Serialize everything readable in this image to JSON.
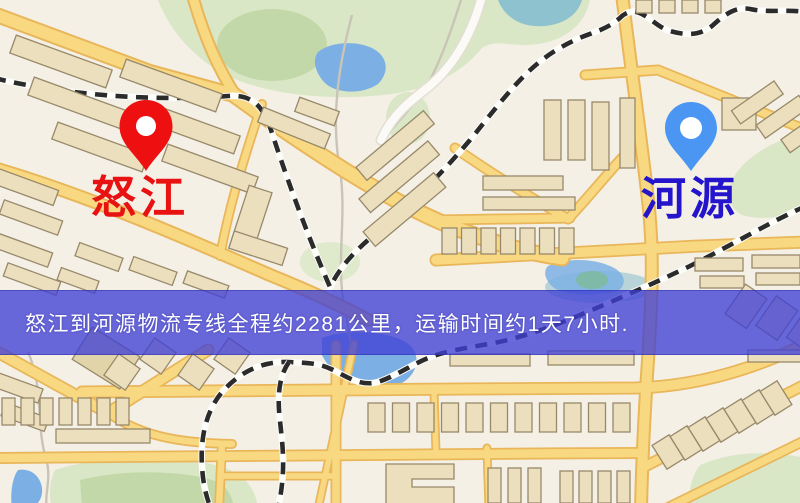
{
  "banner": {
    "text": "怒江到河源物流专线全程约2281公里，运输时间约1天7小时.",
    "distance_text": "约2281公里",
    "duration_text": "约1天7小时"
  },
  "markers": {
    "origin": {
      "label": "怒江"
    },
    "destination": {
      "label": "河源"
    }
  },
  "map": {
    "palette": {
      "bg": "#f4f0e6",
      "road": "#f8d981",
      "roadedge": "#e9b65a",
      "rail": "#2b2b2b",
      "railbase": "#fdfdfa",
      "stream": "#c9c4b6",
      "bldg": "#ebdfbe",
      "bldg2": "#e2d4a9",
      "bldgedge": "#98896a",
      "park": "#dae7c6",
      "parkdark": "#c3d8a8",
      "water": "#7cb0e4",
      "waterteal": "#8fc2cf",
      "bannerbg": "rgba(64,64,213,0.78)",
      "bannertext": "#ffffff",
      "pinorigin": "#ee1010",
      "pindest": "#4a96f2",
      "labelorigin": "#e81212",
      "labeldest": "#2415cd"
    }
  }
}
